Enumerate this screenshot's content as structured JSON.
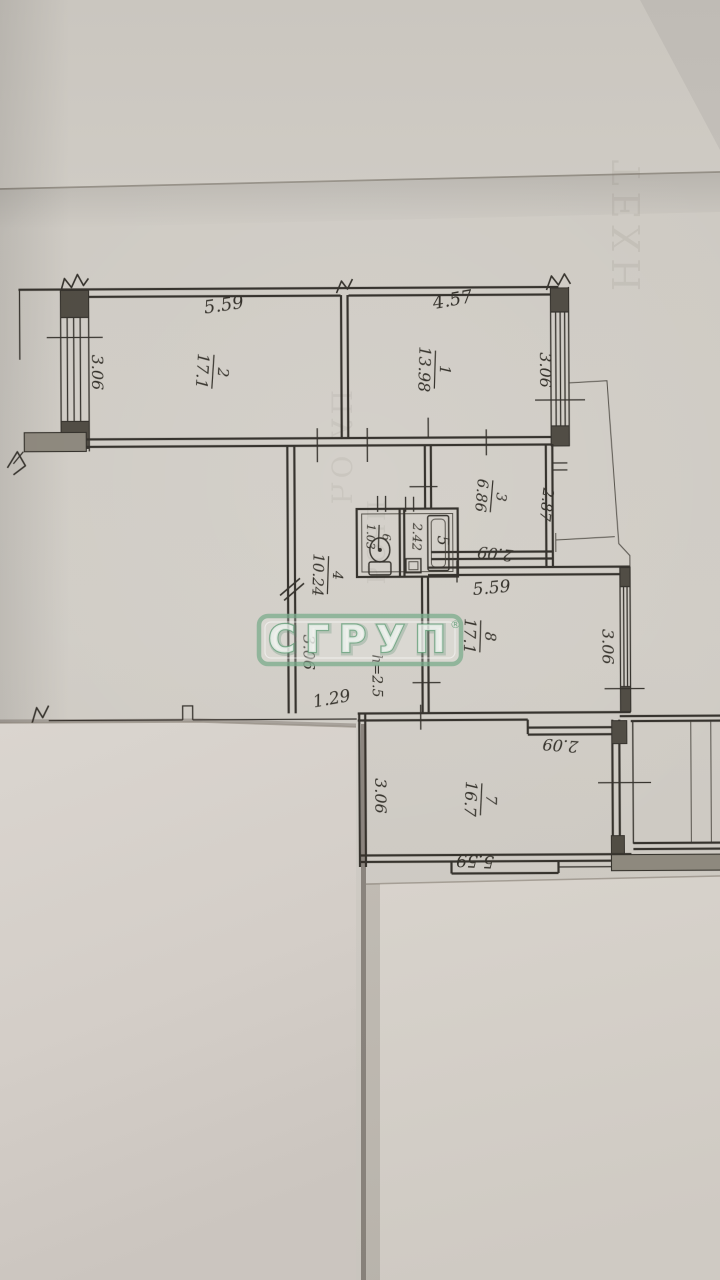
{
  "watermark": {
    "text": "СГРУП",
    "reg": "®",
    "green": "#7fae90"
  },
  "rooms": {
    "r1": {
      "num": "1",
      "area": "13.98"
    },
    "r2": {
      "num": "2",
      "area": "17.1"
    },
    "r3": {
      "num": "3",
      "area": "6.86"
    },
    "r4": {
      "num": "4",
      "area": "10.24"
    },
    "r5": {
      "num": "5"
    },
    "r6": {
      "num": "6",
      "area": "1.03"
    },
    "r7": {
      "num": "7",
      "area": "16.7"
    },
    "r8": {
      "num": "8",
      "area": "17.1"
    }
  },
  "dims": {
    "room2_top": "5.59",
    "room1_top": "4.57",
    "room2_left": "3.06",
    "room1_right": "3.06",
    "room3_right": "2.87",
    "room3_width": "2.09",
    "bath_width": "2.42",
    "hall_left": "3.06",
    "hall_width": "1.29",
    "ceiling_height": "h=2.5",
    "room8_top": "5.59",
    "room8_right": "3.06",
    "vestibule_width": "2.09",
    "room7_left": "3.06",
    "room7_bottom": "5.59"
  },
  "bleed_text": {
    "a": "ТЕХН",
    "b": "ПУ ОЧ",
    "c": "ПРОЧ"
  },
  "colors": {
    "paper": "#cdc9c2",
    "paper_sheets": "#d8d3cc",
    "ink": "#2d2a24",
    "watermark_green": "#7fae90"
  }
}
